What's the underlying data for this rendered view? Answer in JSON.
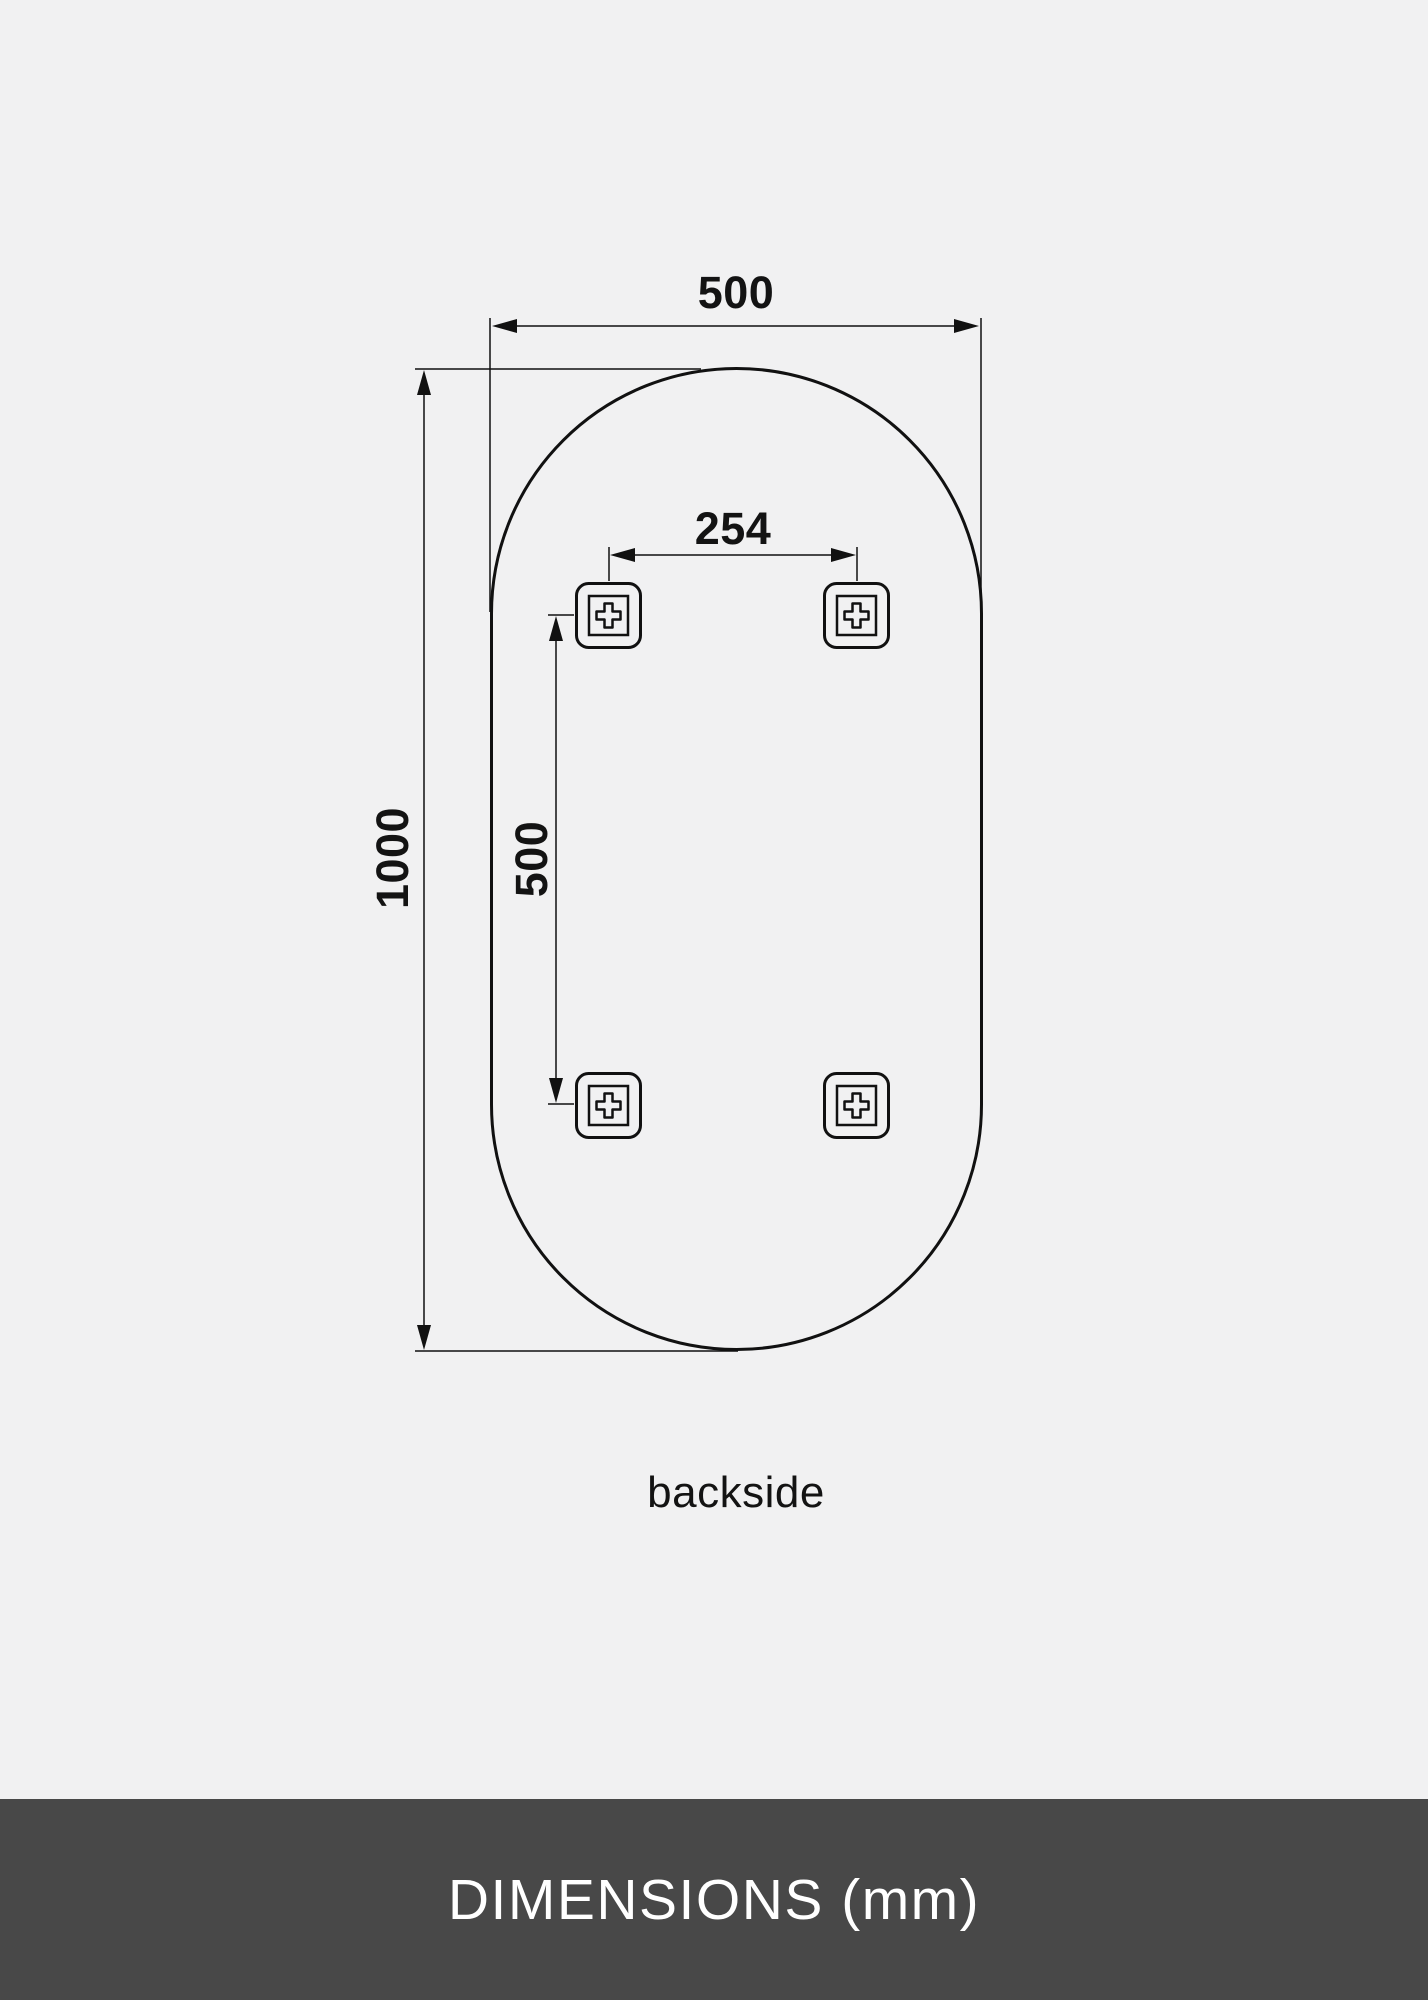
{
  "page": {
    "background_color": "#f1f1f2",
    "line_color": "#111111"
  },
  "diagram": {
    "description": "mirror-backside-dimension-drawing",
    "shape": "pill-oval",
    "view_label": "backside",
    "dimensions": {
      "overall_width": "500",
      "overall_height": "1000",
      "bracket_spacing_horizontal": "254",
      "bracket_spacing_vertical": "500"
    },
    "mounting_brackets_count": 4
  },
  "footer": {
    "title": "DIMENSIONS (mm)",
    "background_color": "#484848",
    "text_color": "#ffffff"
  }
}
